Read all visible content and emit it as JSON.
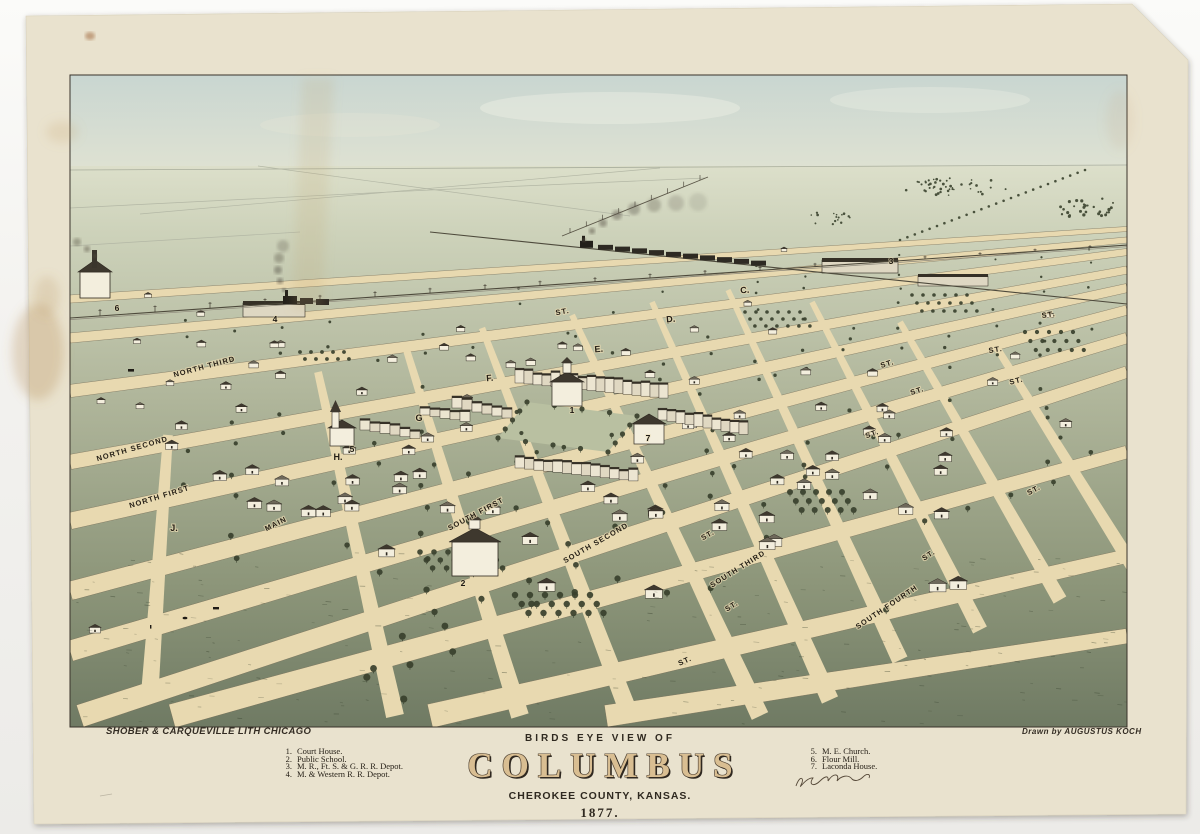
{
  "artwork": {
    "header": "BIRDS EYE VIEW OF",
    "title": "COLUMBUS",
    "subtitle": "CHEROKEE COUNTY, KANSAS.",
    "year": "1877.",
    "lithographer_credit": "SHOBER & CARQUEVILLE LITH CHICAGO",
    "artist_credit": "Drawn by AUGUSTUS KOCH"
  },
  "legend_left": {
    "items": [
      {
        "num": "1.",
        "label": "Court House."
      },
      {
        "num": "2.",
        "label": "Public School."
      },
      {
        "num": "3.",
        "label": "M. R., Ft. S. & G. R. R. Depot."
      },
      {
        "num": "4.",
        "label": "M. & Western R. R. Depot."
      }
    ]
  },
  "legend_right": {
    "items": [
      {
        "num": "5.",
        "label": "M. E. Church."
      },
      {
        "num": "6.",
        "label": "Flour Mill."
      },
      {
        "num": "7.",
        "label": "Laconda House."
      }
    ]
  },
  "map_labels": {
    "streets": [
      {
        "text": "NORTH THIRD",
        "x": 205,
        "y": 369,
        "rot": -15
      },
      {
        "text": "NORTH SECOND",
        "x": 133,
        "y": 451,
        "rot": -16
      },
      {
        "text": "NORTH FIRST",
        "x": 160,
        "y": 499,
        "rot": -17
      },
      {
        "text": "MAIN",
        "x": 277,
        "y": 526,
        "rot": -27
      },
      {
        "text": "SOUTH FIRST",
        "x": 477,
        "y": 516,
        "rot": -28
      },
      {
        "text": "SOUTH SECOND",
        "x": 597,
        "y": 545,
        "rot": -30
      },
      {
        "text": "SOUTH THIRD",
        "x": 739,
        "y": 571,
        "rot": -32
      },
      {
        "text": "SOUTH FOURTH",
        "x": 888,
        "y": 609,
        "rot": -34
      },
      {
        "text": "J.",
        "x": 174,
        "y": 531,
        "rot": 0
      },
      {
        "text": "H.",
        "x": 338,
        "y": 460,
        "rot": 0
      },
      {
        "text": "G",
        "x": 419,
        "y": 421,
        "rot": 0
      },
      {
        "text": "F.",
        "x": 490,
        "y": 381,
        "rot": -5
      },
      {
        "text": "E.",
        "x": 599,
        "y": 352,
        "rot": -5
      },
      {
        "text": "D.",
        "x": 671,
        "y": 322,
        "rot": -5
      },
      {
        "text": "C.",
        "x": 745,
        "y": 293,
        "rot": -5
      },
      {
        "text": "ST.",
        "x": 563,
        "y": 314,
        "rot": -10
      },
      {
        "text": "ST.",
        "x": 1049,
        "y": 317,
        "rot": -8
      },
      {
        "text": "ST.",
        "x": 996,
        "y": 352,
        "rot": -9
      },
      {
        "text": "ST.",
        "x": 888,
        "y": 366,
        "rot": -16
      },
      {
        "text": "ST.",
        "x": 1017,
        "y": 383,
        "rot": -14
      },
      {
        "text": "ST.",
        "x": 918,
        "y": 393,
        "rot": -18
      },
      {
        "text": "ST.",
        "x": 873,
        "y": 436,
        "rot": -20
      },
      {
        "text": "ST.",
        "x": 1035,
        "y": 492,
        "rot": -28
      },
      {
        "text": "ST.",
        "x": 709,
        "y": 537,
        "rot": -30
      },
      {
        "text": "ST.",
        "x": 930,
        "y": 557,
        "rot": -33
      },
      {
        "text": "ST.",
        "x": 733,
        "y": 608,
        "rot": -32
      },
      {
        "text": "ST.",
        "x": 686,
        "y": 663,
        "rot": -24
      }
    ],
    "landmarks": [
      {
        "num": "1",
        "x": 572,
        "y": 413
      },
      {
        "num": "2",
        "x": 463,
        "y": 586
      },
      {
        "num": "3",
        "x": 891,
        "y": 264
      },
      {
        "num": "4",
        "x": 275,
        "y": 322
      },
      {
        "num": "5",
        "x": 352,
        "y": 452
      },
      {
        "num": "6",
        "x": 117,
        "y": 311
      },
      {
        "num": "7",
        "x": 648,
        "y": 441
      }
    ]
  },
  "colors": {
    "paper": "#e9e2ce",
    "sky_top": "#c9d6d1",
    "sky_horizon": "#dfe2d2",
    "ground_far": "#dcdfca",
    "ground_mid": "#b1b79c",
    "ground_near": "#6f7a63",
    "street": "#e8d9b0",
    "ink": "#2c271f",
    "tree": "#38402c",
    "wall": "#f3eedd",
    "roof_dark": "#3e382e",
    "title_fill": "#d9be92",
    "stain": "#b08448"
  }
}
